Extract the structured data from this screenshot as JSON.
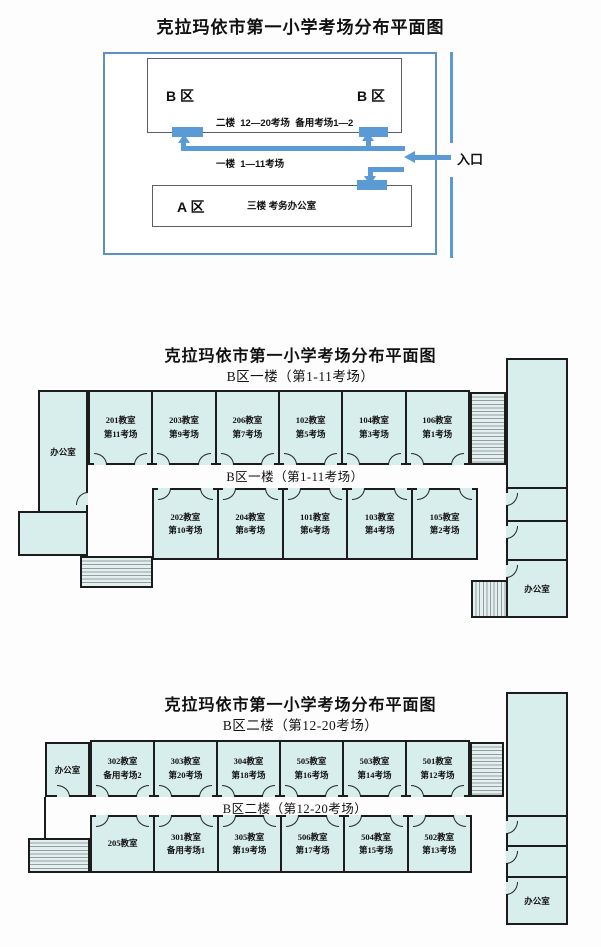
{
  "colors": {
    "accent_blue": "#5b9bd5",
    "room_fill": "#d8eeec",
    "wall": "#1c1c1c"
  },
  "overview": {
    "title": "克拉玛依市第一小学考场分布平面图",
    "b_zone_left_label": "B 区",
    "b_zone_right_label": "B 区",
    "b_info_line1": "二楼  12—20考场  备用考场1—2",
    "b_info_line2": "一楼  1—11考场",
    "a_zone_label": "A 区",
    "a_info": "三楼 考务办公室",
    "entrance_label": "入口"
  },
  "floor1": {
    "title": "克拉玛依市第一小学考场分布平面图",
    "subtitle": "B区一楼（第1-11考场）",
    "corridor_label": "B区一楼（第1-11考场）",
    "office_left": "办公室",
    "office_right": "办公室",
    "top_rooms": [
      {
        "room": "201教室",
        "session": "第11考场"
      },
      {
        "room": "203教室",
        "session": "第9考场"
      },
      {
        "room": "206教室",
        "session": "第7考场"
      },
      {
        "room": "102教室",
        "session": "第5考场"
      },
      {
        "room": "104教室",
        "session": "第3考场"
      },
      {
        "room": "106教室",
        "session": "第1考场"
      }
    ],
    "bottom_rooms": [
      {
        "room": "202教室",
        "session": "第10考场"
      },
      {
        "room": "204教室",
        "session": "第8考场"
      },
      {
        "room": "101教室",
        "session": "第6考场"
      },
      {
        "room": "103教室",
        "session": "第4考场"
      },
      {
        "room": "105教室",
        "session": "第2考场"
      }
    ]
  },
  "floor2": {
    "title": "克拉玛依市第一小学考场分布平面图",
    "subtitle": "B区二楼（第12-20考场）",
    "corridor_label": "B区二楼（第12-20考场）",
    "office_left": "办公室",
    "office_right": "办公室",
    "top_rooms": [
      {
        "room": "302教室",
        "session": "备用考场2"
      },
      {
        "room": "303教室",
        "session": "第20考场"
      },
      {
        "room": "304教室",
        "session": "第18考场"
      },
      {
        "room": "505教室",
        "session": "第16考场"
      },
      {
        "room": "503教室",
        "session": "第14考场"
      },
      {
        "room": "501教室",
        "session": "第12考场"
      }
    ],
    "bottom_rooms": [
      {
        "room": "205教室",
        "session": ""
      },
      {
        "room": "301教室",
        "session": "备用考场1"
      },
      {
        "room": "305教室",
        "session": "第19考场"
      },
      {
        "room": "506教室",
        "session": "第17考场"
      },
      {
        "room": "504教室",
        "session": "第15考场"
      },
      {
        "room": "502教室",
        "session": "第13考场"
      }
    ]
  }
}
